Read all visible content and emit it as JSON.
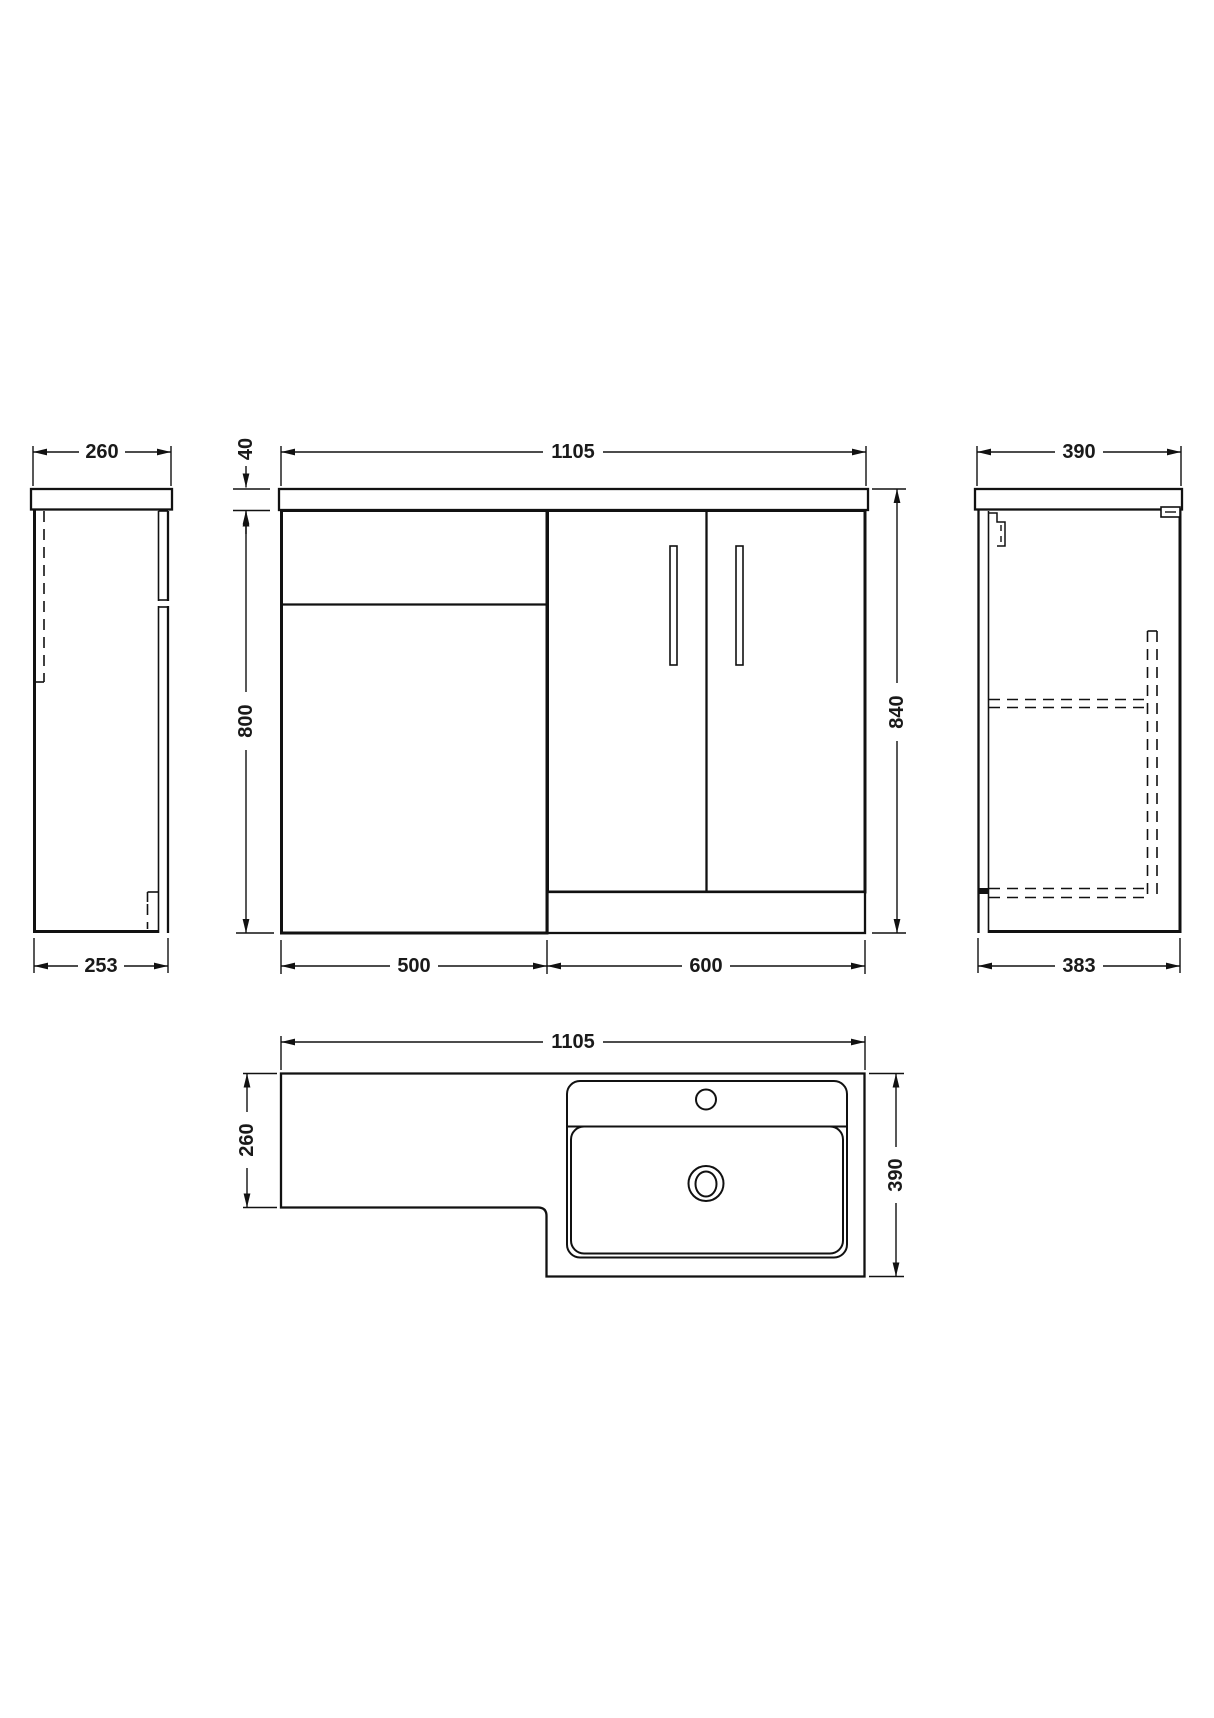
{
  "drawing": {
    "description": "Technical dimension drawing of L-shaped bathroom vanity and WC combination unit",
    "units": "mm",
    "front": {
      "width": "1105",
      "worktop_thickness": "40",
      "cabinet_height": "800",
      "total_height": "840",
      "wc_unit_width": "500",
      "vanity_unit_width": "600"
    },
    "side_left": {
      "worktop_depth": "260",
      "base_depth": "253"
    },
    "side_right": {
      "worktop_depth": "390",
      "base_depth": "383"
    },
    "plan": {
      "width": "1105",
      "left_depth": "260",
      "right_depth": "390"
    }
  }
}
